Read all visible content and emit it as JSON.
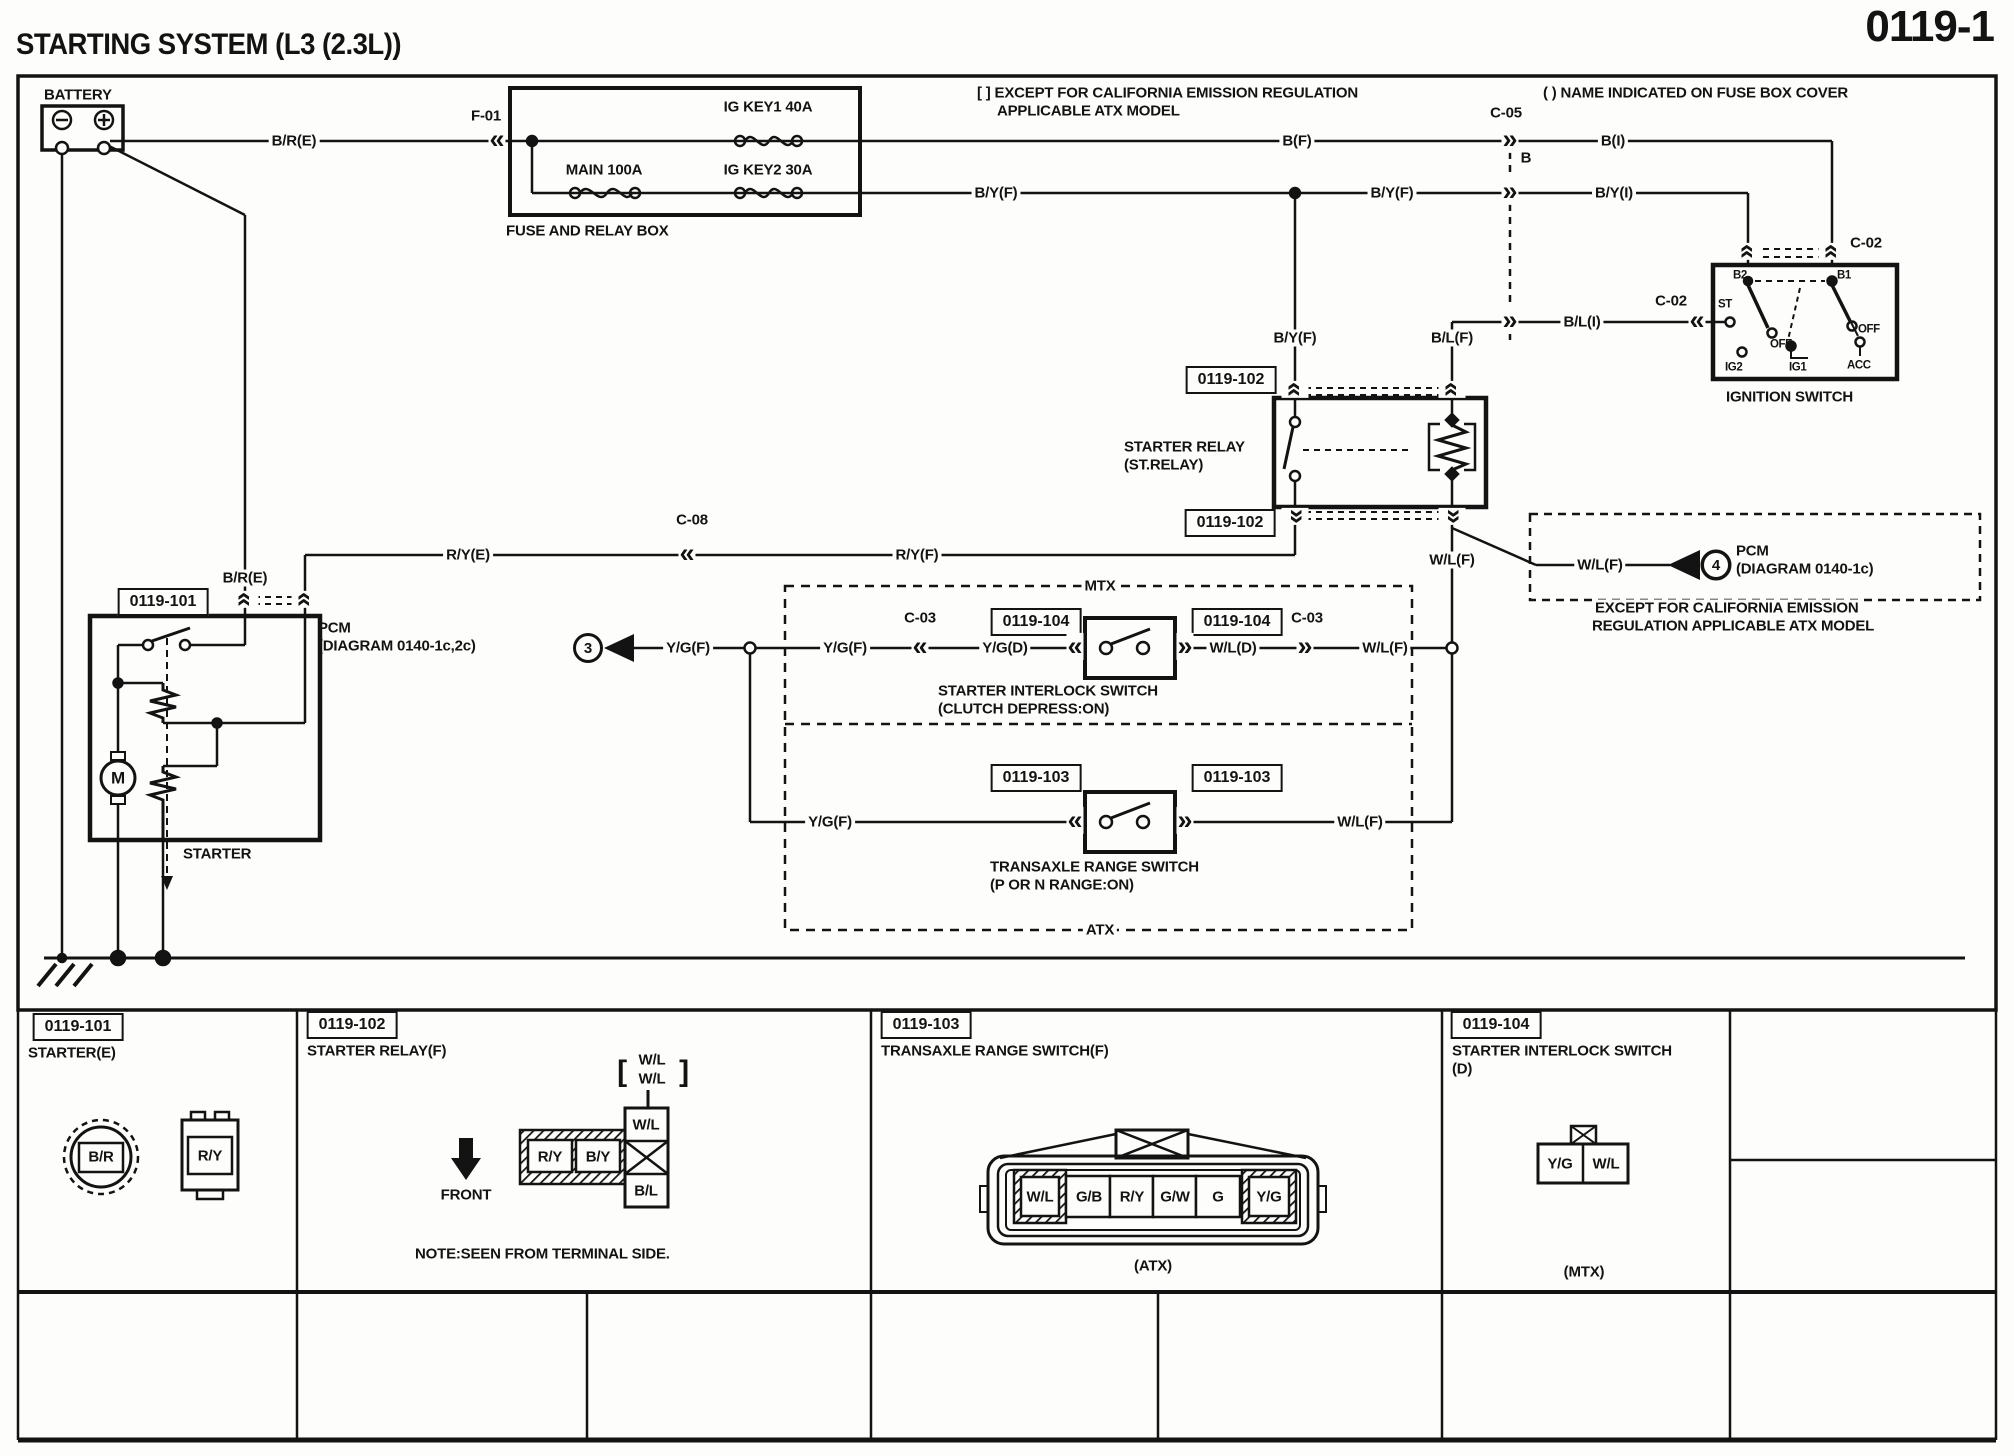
{
  "header": {
    "title": "STARTING SYSTEM (L3 (2.3L))",
    "page_number": "0119-1"
  },
  "diagram": {
    "wire_labels": [
      {
        "t": "B/R(E)",
        "x": 294,
        "y": 141
      },
      {
        "t": "F-01",
        "x": 486,
        "y": 116
      },
      {
        "t": "MAIN 100A",
        "x": 604,
        "y": 170
      },
      {
        "t": "IG KEY1 40A",
        "x": 768,
        "y": 107
      },
      {
        "t": "IG KEY2 30A",
        "x": 768,
        "y": 170
      },
      {
        "t": "B/Y(F)",
        "x": 996,
        "y": 193
      },
      {
        "t": "B(F)",
        "x": 1297,
        "y": 141
      },
      {
        "t": "C-05",
        "x": 1506,
        "y": 113
      },
      {
        "t": "B",
        "x": 1526,
        "y": 158
      },
      {
        "t": "B(I)",
        "x": 1613,
        "y": 141
      },
      {
        "t": "B/Y(F)",
        "x": 1392,
        "y": 193
      },
      {
        "t": "B/Y(I)",
        "x": 1614,
        "y": 193
      },
      {
        "t": "C-02",
        "x": 1866,
        "y": 243
      },
      {
        "t": "C-02",
        "x": 1671,
        "y": 301
      },
      {
        "t": "B/L(I)",
        "x": 1582,
        "y": 322
      },
      {
        "t": "B/Y(F)",
        "x": 1295,
        "y": 338
      },
      {
        "t": "B/L(F)",
        "x": 1452,
        "y": 338
      },
      {
        "t": "B/R(E)",
        "x": 245,
        "y": 578
      },
      {
        "t": "R/Y(E)",
        "x": 468,
        "y": 555
      },
      {
        "t": "C-08",
        "x": 692,
        "y": 520
      },
      {
        "t": "R/Y(F)",
        "x": 917,
        "y": 555
      },
      {
        "t": "W/L(F)",
        "x": 1452,
        "y": 560
      },
      {
        "t": "W/L(F)",
        "x": 1600,
        "y": 565
      },
      {
        "t": "Y/G(F)",
        "x": 688,
        "y": 648
      },
      {
        "t": "Y/G(F)",
        "x": 845,
        "y": 648
      },
      {
        "t": "C-03",
        "x": 920,
        "y": 618
      },
      {
        "t": "Y/G(D)",
        "x": 1005,
        "y": 648
      },
      {
        "t": "W/L(D)",
        "x": 1233,
        "y": 648
      },
      {
        "t": "C-03",
        "x": 1307,
        "y": 618
      },
      {
        "t": "W/L(F)",
        "x": 1385,
        "y": 648
      },
      {
        "t": "MTX",
        "x": 1100,
        "y": 586
      },
      {
        "t": "Y/G(F)",
        "x": 830,
        "y": 822
      },
      {
        "t": "W/L(F)",
        "x": 1360,
        "y": 822
      },
      {
        "t": "ATX",
        "x": 1100,
        "y": 930
      }
    ],
    "component_labels": [
      {
        "t": "BATTERY",
        "x": 44,
        "y": 95
      },
      {
        "t": "FUSE AND RELAY BOX",
        "x": 506,
        "y": 231
      },
      {
        "t": "[ ] EXCEPT FOR CALIFORNIA EMISSION REGULATION",
        "x": 977,
        "y": 93
      },
      {
        "t": "APPLICABLE ATX MODEL",
        "x": 997,
        "y": 111
      },
      {
        "t": "( ) NAME INDICATED ON FUSE BOX COVER",
        "x": 1543,
        "y": 93
      },
      {
        "t": "IGNITION SWITCH",
        "x": 1726,
        "y": 397
      },
      {
        "t": "STARTER RELAY",
        "x": 1124,
        "y": 447
      },
      {
        "t": "(ST.RELAY)",
        "x": 1124,
        "y": 465
      },
      {
        "t": "PCM",
        "x": 1736,
        "y": 551
      },
      {
        "t": "(DIAGRAM 0140-1c)",
        "x": 1736,
        "y": 569
      },
      {
        "t": "EXCEPT FOR CALIFORNIA EMISSION",
        "x": 1592,
        "y": 608,
        "bg": 1
      },
      {
        "t": "REGULATION APPLICABLE ATX MODEL",
        "x": 1592,
        "y": 626
      },
      {
        "t": "PCM",
        "x": 318,
        "y": 628
      },
      {
        "t": "(DIAGRAM 0140-1c,2c)",
        "x": 318,
        "y": 646
      },
      {
        "t": "STARTER",
        "x": 183,
        "y": 854
      },
      {
        "t": "STARTER INTERLOCK SWITCH",
        "x": 938,
        "y": 691
      },
      {
        "t": "(CLUTCH DEPRESS:ON)",
        "x": 938,
        "y": 709
      },
      {
        "t": "TRANSAXLE RANGE SWITCH",
        "x": 990,
        "y": 867
      },
      {
        "t": "(P OR N RANGE:ON)",
        "x": 990,
        "y": 885
      },
      {
        "t": "M",
        "x": 118,
        "y": 778,
        "anchor": "middle",
        "size": 17
      },
      {
        "t": "STARTER(E)",
        "x": 28,
        "y": 1053
      },
      {
        "t": "STARTER RELAY(F)",
        "x": 307,
        "y": 1051
      },
      {
        "t": "TRANSAXLE RANGE SWITCH(F)",
        "x": 881,
        "y": 1051
      },
      {
        "t": "STARTER INTERLOCK SWITCH",
        "x": 1452,
        "y": 1051
      },
      {
        "t": "(D)",
        "x": 1452,
        "y": 1069
      },
      {
        "t": "W/L",
        "x": 652,
        "y": 1060,
        "anchor": "middle"
      },
      {
        "t": "W/L",
        "x": 652,
        "y": 1079,
        "anchor": "middle"
      },
      {
        "t": "[",
        "x": 622,
        "y": 1072,
        "anchor": "middle",
        "size": 30
      },
      {
        "t": "]",
        "x": 684,
        "y": 1072,
        "anchor": "middle",
        "size": 30
      },
      {
        "t": "FRONT",
        "x": 466,
        "y": 1195,
        "anchor": "middle"
      },
      {
        "t": "NOTE:SEEN FROM TERMINAL SIDE.",
        "x": 415,
        "y": 1254
      },
      {
        "t": "(ATX)",
        "x": 1153,
        "y": 1266,
        "anchor": "middle"
      },
      {
        "t": "(MTX)",
        "x": 1584,
        "y": 1272,
        "anchor": "middle"
      },
      {
        "t": "B/R",
        "x": 101,
        "y": 1157,
        "anchor": "middle"
      },
      {
        "t": "R/Y",
        "x": 210,
        "y": 1156,
        "anchor": "middle"
      },
      {
        "t": "R/Y",
        "x": 550,
        "y": 1157,
        "anchor": "middle"
      },
      {
        "t": "B/Y",
        "x": 598,
        "y": 1157,
        "anchor": "middle"
      },
      {
        "t": "W/L",
        "x": 646,
        "y": 1125,
        "anchor": "middle"
      },
      {
        "t": "B/L",
        "x": 646,
        "y": 1191,
        "anchor": "middle"
      },
      {
        "t": "W/L",
        "x": 1040,
        "y": 1197,
        "anchor": "middle"
      },
      {
        "t": "G/B",
        "x": 1089,
        "y": 1197,
        "anchor": "middle"
      },
      {
        "t": "R/Y",
        "x": 1132,
        "y": 1197,
        "anchor": "middle"
      },
      {
        "t": "G/W",
        "x": 1175,
        "y": 1197,
        "anchor": "middle"
      },
      {
        "t": "G",
        "x": 1218,
        "y": 1197,
        "anchor": "middle"
      },
      {
        "t": "Y/G",
        "x": 1269,
        "y": 1197,
        "anchor": "middle"
      },
      {
        "t": "Y/G",
        "x": 1560,
        "y": 1164,
        "anchor": "middle"
      },
      {
        "t": "W/L",
        "x": 1606,
        "y": 1164,
        "anchor": "middle"
      }
    ],
    "pin_labels": [
      {
        "t": "B2",
        "x": 1733,
        "y": 276
      },
      {
        "t": "B1",
        "x": 1837,
        "y": 276
      },
      {
        "t": "ST",
        "x": 1718,
        "y": 305
      },
      {
        "t": "OFF",
        "x": 1770,
        "y": 345
      },
      {
        "t": "OFF",
        "x": 1858,
        "y": 330
      },
      {
        "t": "IG2",
        "x": 1725,
        "y": 368
      },
      {
        "t": "IG1",
        "x": 1789,
        "y": 368
      },
      {
        "t": "ACC",
        "x": 1847,
        "y": 366
      }
    ],
    "connector_refs": [
      {
        "t": "0119-101",
        "x": 163,
        "y": 602
      },
      {
        "t": "0119-102",
        "x": 1231,
        "y": 380
      },
      {
        "t": "0119-102",
        "x": 1230,
        "y": 523
      },
      {
        "t": "0119-104",
        "x": 1036,
        "y": 622
      },
      {
        "t": "0119-104",
        "x": 1237,
        "y": 622
      },
      {
        "t": "0119-103",
        "x": 1036,
        "y": 778
      },
      {
        "t": "0119-103",
        "x": 1237,
        "y": 778
      },
      {
        "t": "0119-101",
        "x": 78,
        "y": 1027
      },
      {
        "t": "0119-102",
        "x": 352,
        "y": 1025
      },
      {
        "t": "0119-103",
        "x": 926,
        "y": 1025
      },
      {
        "t": "0119-104",
        "x": 1496,
        "y": 1025
      }
    ],
    "connector_arrows": [
      {
        "g": "«",
        "x": 497,
        "y": 141
      },
      {
        "g": "»",
        "x": 1510,
        "y": 141
      },
      {
        "g": "»",
        "x": 1510,
        "y": 193
      },
      {
        "g": "»",
        "x": 1510,
        "y": 322
      },
      {
        "g": "«",
        "x": 1697,
        "y": 322
      },
      {
        "g": "«",
        "x": 687,
        "y": 555
      },
      {
        "g": "«",
        "x": 920,
        "y": 648
      },
      {
        "g": "«",
        "x": 1075,
        "y": 648
      },
      {
        "g": "»",
        "x": 1185,
        "y": 648
      },
      {
        "g": "»",
        "x": 1305,
        "y": 648
      },
      {
        "g": "«",
        "x": 1075,
        "y": 822
      },
      {
        "g": "»",
        "x": 1185,
        "y": 822
      },
      {
        "g": "«",
        "x": 245,
        "y": 601,
        "r": "u"
      },
      {
        "g": "«",
        "x": 305,
        "y": 601,
        "r": "u"
      },
      {
        "g": "«",
        "x": 1295,
        "y": 391,
        "r": "u"
      },
      {
        "g": "«",
        "x": 1452,
        "y": 391,
        "r": "u"
      },
      {
        "g": "«",
        "x": 1295,
        "y": 518,
        "r": "d"
      },
      {
        "g": "«",
        "x": 1452,
        "y": 518,
        "r": "d"
      },
      {
        "g": "«",
        "x": 1748,
        "y": 253,
        "r": "u"
      },
      {
        "g": "«",
        "x": 1832,
        "y": 253,
        "r": "u"
      }
    ],
    "ref_circles": [
      {
        "t": "3",
        "x": 588,
        "y": 648
      },
      {
        "t": "4",
        "x": 1716,
        "y": 565
      }
    ]
  }
}
